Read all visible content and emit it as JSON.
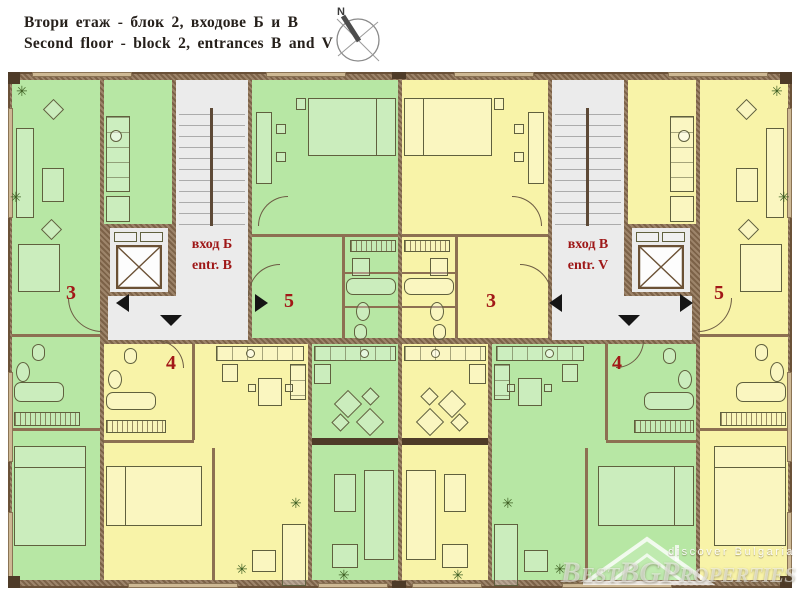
{
  "header": {
    "title_line1": "Втори етаж - блок 2, входове Б и В",
    "title_line2": "Second floor - block 2, entrances B and V",
    "compass_north": "N"
  },
  "floor_plan": {
    "entrance_left": {
      "name_bg": "вход Б",
      "name_en": "entr. B"
    },
    "entrance_right": {
      "name_bg": "вход В",
      "name_en": "entr. V"
    },
    "apartment_numbers": {
      "left_3": "3",
      "left_5": "5",
      "left_4": "4",
      "right_3": "3",
      "right_5": "5",
      "right_4": "4"
    },
    "colors": {
      "apartment_green": "#b7e7a4",
      "apartment_yellow": "#f8f3a8",
      "wall_brown": "#8d7052",
      "corridor_grey": "#ebebeb",
      "label_red": "#a21717"
    }
  },
  "watermark": {
    "tagline": "discover Bulgaria",
    "brand": "BestBGProperties"
  }
}
